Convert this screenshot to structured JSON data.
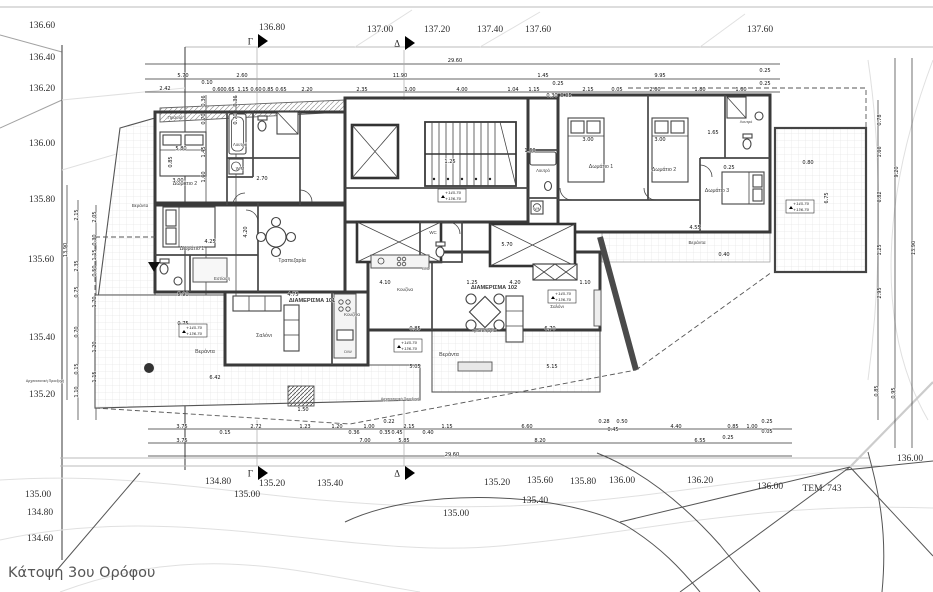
{
  "title": "Κάτοψη 3ου Ορόφου",
  "parcel_label": "ΤΕΜ. 743",
  "colors": {
    "wall": "#3a3a3a",
    "tile": "#dcdcdc",
    "hatch": "#9a9a9a",
    "contour_light": "#e0e0e0",
    "contour_dark": "#555555",
    "accent": "#000000"
  },
  "contours": {
    "left": [
      {
        "x": 42,
        "y": 28,
        "v": "136.60"
      },
      {
        "x": 42,
        "y": 60,
        "v": "136.40"
      },
      {
        "x": 42,
        "y": 91,
        "v": "136.20"
      },
      {
        "x": 42,
        "y": 146,
        "v": "136.00"
      },
      {
        "x": 42,
        "y": 202,
        "v": "135.80"
      },
      {
        "x": 41,
        "y": 262,
        "v": "135.60"
      },
      {
        "x": 42,
        "y": 340,
        "v": "135.40"
      },
      {
        "x": 42,
        "y": 397,
        "v": "135.20"
      },
      {
        "x": 38,
        "y": 497,
        "v": "135.00"
      },
      {
        "x": 40,
        "y": 515,
        "v": "134.80"
      },
      {
        "x": 40,
        "y": 541,
        "v": "134.60"
      }
    ],
    "top": [
      {
        "x": 272,
        "y": 30,
        "v": "136.80"
      },
      {
        "x": 380,
        "y": 32,
        "v": "137.00"
      },
      {
        "x": 437,
        "y": 32,
        "v": "137.20"
      },
      {
        "x": 490,
        "y": 32,
        "v": "137.40"
      },
      {
        "x": 538,
        "y": 32,
        "v": "137.60"
      },
      {
        "x": 760,
        "y": 32,
        "v": "137.60"
      }
    ],
    "bottom": [
      {
        "x": 218,
        "y": 484,
        "v": "134.80"
      },
      {
        "x": 272,
        "y": 486,
        "v": "135.20"
      },
      {
        "x": 247,
        "y": 497,
        "v": "135.00"
      },
      {
        "x": 330,
        "y": 486,
        "v": "135.40"
      },
      {
        "x": 497,
        "y": 485,
        "v": "135.20"
      },
      {
        "x": 540,
        "y": 483,
        "v": "135.60"
      },
      {
        "x": 535,
        "y": 503,
        "v": "135.40"
      },
      {
        "x": 456,
        "y": 516,
        "v": "135.00"
      },
      {
        "x": 583,
        "y": 484,
        "v": "135.80"
      },
      {
        "x": 622,
        "y": 483,
        "v": "136.00"
      },
      {
        "x": 700,
        "y": 483,
        "v": "136.20"
      },
      {
        "x": 770,
        "y": 489,
        "v": "136.00"
      },
      {
        "x": 910,
        "y": 461,
        "v": "136.00"
      }
    ]
  },
  "sections": [
    {
      "l": "Γ",
      "x": 257,
      "y": 41
    },
    {
      "l": "Δ",
      "x": 404,
      "y": 43
    },
    {
      "l": "Γ",
      "x": 257,
      "y": 473
    },
    {
      "l": "Δ",
      "x": 404,
      "y": 473
    }
  ],
  "levels": [
    {
      "x": 193,
      "y": 331,
      "l1": "+145.70",
      "l2": "+136.70"
    },
    {
      "x": 452,
      "y": 196,
      "l1": "+145.70",
      "l2": "+136.70"
    },
    {
      "x": 562,
      "y": 297,
      "l1": "+145.70",
      "l2": "+136.70"
    },
    {
      "x": 800,
      "y": 207,
      "l1": "+145.70",
      "l2": "+136.70"
    },
    {
      "x": 408,
      "y": 346,
      "l1": "+145.70",
      "l2": "+136.70"
    }
  ],
  "rooms": [
    {
      "x": 175,
      "y": 119,
      "v": "Πρασιά",
      "fs": 4.6
    },
    {
      "x": 185,
      "y": 185,
      "v": "Δωμάτιο 2"
    },
    {
      "x": 240,
      "y": 146,
      "v": "Λουτρό",
      "fs": 4.3
    },
    {
      "x": 240,
      "y": 170,
      "v": "W/M",
      "fs": 4.2
    },
    {
      "x": 140,
      "y": 207,
      "v": "Βεράντα",
      "fs": 4.4
    },
    {
      "x": 192,
      "y": 250,
      "v": "Δωμάτιο 1"
    },
    {
      "x": 222,
      "y": 280,
      "v": "Εστίαση",
      "fs": 4.4
    },
    {
      "x": 292,
      "y": 262,
      "v": "Τραπεζαρία"
    },
    {
      "x": 264,
      "y": 337,
      "v": "Σαλόνι"
    },
    {
      "x": 205,
      "y": 353,
      "v": "Βεράντα"
    },
    {
      "x": 312,
      "y": 302,
      "v": "ΔΙΑΜΕΡΙΣΜΑ 101",
      "fs": 5.6,
      "b": 1
    },
    {
      "x": 352,
      "y": 316,
      "v": "Κουζίνα",
      "fs": 4.6
    },
    {
      "x": 348,
      "y": 353,
      "v": "D/W",
      "fs": 3.9
    },
    {
      "x": 405,
      "y": 291,
      "v": "Κουζίνα",
      "fs": 4.6
    },
    {
      "x": 426,
      "y": 270,
      "v": "D/W",
      "fs": 3.9
    },
    {
      "x": 494,
      "y": 289,
      "v": "ΔΙΑΜΕΡΙΣΜΑ 102",
      "fs": 5.6,
      "b": 1
    },
    {
      "x": 484,
      "y": 332,
      "v": "Τραπεζαρία",
      "fs": 4.8
    },
    {
      "x": 557,
      "y": 308,
      "v": "Σαλόνι",
      "fs": 4.6
    },
    {
      "x": 449,
      "y": 356,
      "v": "Βεράντα"
    },
    {
      "x": 433,
      "y": 234,
      "v": "WC",
      "fs": 4.4
    },
    {
      "x": 543,
      "y": 172,
      "v": "Λουτρό",
      "fs": 4.2
    },
    {
      "x": 537,
      "y": 210,
      "v": "W/M",
      "fs": 4
    },
    {
      "x": 601,
      "y": 168,
      "v": "Δωμάτιο 1"
    },
    {
      "x": 664,
      "y": 171,
      "v": "Δωμάτιο 2"
    },
    {
      "x": 717,
      "y": 192,
      "v": "Δωμάτιο 3"
    },
    {
      "x": 746,
      "y": 123,
      "v": "Λουτρό",
      "fs": 3.8
    },
    {
      "x": 697,
      "y": 244,
      "v": "Βεράντα",
      "fs": 4.6
    },
    {
      "x": 45,
      "y": 382,
      "v": "Αρχιτεκτονική Προεξοχή",
      "fs": 3.6
    },
    {
      "x": 400,
      "y": 400,
      "v": "Αρχιτεκτονική Προεξοχή",
      "fs": 3.6
    }
  ],
  "dims": [
    {
      "x": 455,
      "y": 62,
      "v": "29.60"
    },
    {
      "x": 183,
      "y": 77,
      "v": "5.70"
    },
    {
      "x": 242,
      "y": 77,
      "v": "2.60"
    },
    {
      "x": 400,
      "y": 77,
      "v": "11.90"
    },
    {
      "x": 543,
      "y": 77,
      "v": "1.45"
    },
    {
      "x": 660,
      "y": 77,
      "v": "9.95"
    },
    {
      "x": 765,
      "y": 72,
      "v": "0.25"
    },
    {
      "x": 165,
      "y": 90,
      "v": "2.42"
    },
    {
      "x": 207,
      "y": 84,
      "v": "0.10"
    },
    {
      "x": 218,
      "y": 91,
      "v": "0.60"
    },
    {
      "x": 229,
      "y": 91,
      "v": "0.65"
    },
    {
      "x": 243,
      "y": 91,
      "v": "1.15"
    },
    {
      "x": 256,
      "y": 91,
      "v": "0.60"
    },
    {
      "x": 268,
      "y": 91,
      "v": "0.85"
    },
    {
      "x": 281,
      "y": 91,
      "v": "0.65"
    },
    {
      "x": 307,
      "y": 91,
      "v": "2.20"
    },
    {
      "x": 362,
      "y": 91,
      "v": "2.35"
    },
    {
      "x": 410,
      "y": 91,
      "v": "1.00"
    },
    {
      "x": 462,
      "y": 91,
      "v": "4.00"
    },
    {
      "x": 513,
      "y": 91,
      "v": "1.04"
    },
    {
      "x": 534,
      "y": 91,
      "v": "1.15"
    },
    {
      "x": 558,
      "y": 85,
      "v": "0.25"
    },
    {
      "x": 552,
      "y": 97,
      "v": "0.30"
    },
    {
      "x": 566,
      "y": 97,
      "v": "0.05"
    },
    {
      "x": 588,
      "y": 91,
      "v": "2.15"
    },
    {
      "x": 617,
      "y": 91,
      "v": "0.05"
    },
    {
      "x": 655,
      "y": 91,
      "v": "2.60"
    },
    {
      "x": 700,
      "y": 91,
      "v": "1.80"
    },
    {
      "x": 741,
      "y": 91,
      "v": "1.60"
    },
    {
      "x": 765,
      "y": 85,
      "v": "0.25"
    },
    {
      "x": 182,
      "y": 428,
      "v": "3.75"
    },
    {
      "x": 225,
      "y": 434,
      "v": "0.15"
    },
    {
      "x": 256,
      "y": 428,
      "v": "2.72"
    },
    {
      "x": 305,
      "y": 428,
      "v": "1.23"
    },
    {
      "x": 337,
      "y": 428,
      "v": "1.20"
    },
    {
      "x": 354,
      "y": 434,
      "v": "0.36"
    },
    {
      "x": 369,
      "y": 428,
      "v": "1.00"
    },
    {
      "x": 389,
      "y": 423,
      "v": "0.22"
    },
    {
      "x": 385,
      "y": 434,
      "v": "0.35"
    },
    {
      "x": 397,
      "y": 434,
      "v": "0.45"
    },
    {
      "x": 409,
      "y": 428,
      "v": "2.15"
    },
    {
      "x": 428,
      "y": 434,
      "v": "0.40"
    },
    {
      "x": 447,
      "y": 428,
      "v": "1.15"
    },
    {
      "x": 527,
      "y": 428,
      "v": "6.60"
    },
    {
      "x": 604,
      "y": 423,
      "v": "0.28"
    },
    {
      "x": 622,
      "y": 423,
      "v": "0.50"
    },
    {
      "x": 613,
      "y": 431,
      "v": "0.45"
    },
    {
      "x": 676,
      "y": 428,
      "v": "4.40"
    },
    {
      "x": 733,
      "y": 428,
      "v": "0.85"
    },
    {
      "x": 752,
      "y": 428,
      "v": "1.00"
    },
    {
      "x": 767,
      "y": 423,
      "v": "0.25"
    },
    {
      "x": 767,
      "y": 433,
      "v": "0.05"
    },
    {
      "x": 182,
      "y": 442,
      "v": "3.75"
    },
    {
      "x": 365,
      "y": 442,
      "v": "7.00"
    },
    {
      "x": 728,
      "y": 439,
      "v": "0.25"
    },
    {
      "x": 404,
      "y": 442,
      "v": "5.85"
    },
    {
      "x": 540,
      "y": 442,
      "v": "8.20"
    },
    {
      "x": 700,
      "y": 442,
      "v": "6.55"
    },
    {
      "x": 452,
      "y": 456,
      "v": "29.60"
    },
    {
      "x": 303,
      "y": 411,
      "v": "1.50"
    },
    {
      "x": 205,
      "y": 101,
      "v": "0.36",
      "r": 1
    },
    {
      "x": 205,
      "y": 119,
      "v": "0.70",
      "r": 1
    },
    {
      "x": 237,
      "y": 101,
      "v": "0.36",
      "r": 1
    },
    {
      "x": 237,
      "y": 119,
      "v": "0.70",
      "r": 1
    },
    {
      "x": 205,
      "y": 152,
      "v": "1.45",
      "r": 1
    },
    {
      "x": 205,
      "y": 177,
      "v": "1.60",
      "r": 1
    },
    {
      "x": 172,
      "y": 162,
      "v": "0.85",
      "r": 1
    },
    {
      "x": 67,
      "y": 250,
      "v": "13.90",
      "r": 1
    },
    {
      "x": 78,
      "y": 215,
      "v": "2.15",
      "r": 1
    },
    {
      "x": 96,
      "y": 217,
      "v": "2.05",
      "r": 1
    },
    {
      "x": 96,
      "y": 240,
      "v": "0.30",
      "r": 1
    },
    {
      "x": 96,
      "y": 255,
      "v": "1.15",
      "r": 1
    },
    {
      "x": 78,
      "y": 266,
      "v": "2.35",
      "r": 1
    },
    {
      "x": 96,
      "y": 271,
      "v": "0.50",
      "r": 1
    },
    {
      "x": 78,
      "y": 292,
      "v": "0.75",
      "r": 1
    },
    {
      "x": 96,
      "y": 302,
      "v": "1.70",
      "r": 1
    },
    {
      "x": 78,
      "y": 332,
      "v": "0.70",
      "r": 1
    },
    {
      "x": 96,
      "y": 347,
      "v": "1.20",
      "r": 1
    },
    {
      "x": 78,
      "y": 369,
      "v": "0.15",
      "r": 1
    },
    {
      "x": 96,
      "y": 377,
      "v": "1.15",
      "r": 1
    },
    {
      "x": 78,
      "y": 392,
      "v": "1.10",
      "r": 1
    },
    {
      "x": 881,
      "y": 120,
      "v": "0.78",
      "r": 1
    },
    {
      "x": 881,
      "y": 152,
      "v": "1.66",
      "r": 1
    },
    {
      "x": 898,
      "y": 172,
      "v": "9.20",
      "r": 1
    },
    {
      "x": 881,
      "y": 197,
      "v": "6.82",
      "r": 1
    },
    {
      "x": 881,
      "y": 250,
      "v": "1.25",
      "r": 1
    },
    {
      "x": 915,
      "y": 248,
      "v": "13.90",
      "r": 1
    },
    {
      "x": 881,
      "y": 293,
      "v": "2.95",
      "r": 1
    },
    {
      "x": 878,
      "y": 391,
      "v": "0.85",
      "r": 1
    },
    {
      "x": 895,
      "y": 393,
      "v": "0.95",
      "r": 1
    },
    {
      "x": 181,
      "y": 150,
      "v": "5.80"
    },
    {
      "x": 178,
      "y": 182,
      "v": "3.00"
    },
    {
      "x": 262,
      "y": 180,
      "v": "2.70"
    },
    {
      "x": 210,
      "y": 243,
      "v": "4.25"
    },
    {
      "x": 183,
      "y": 296,
      "v": "5.90"
    },
    {
      "x": 183,
      "y": 325,
      "v": "0.75"
    },
    {
      "x": 215,
      "y": 379,
      "v": "6.42"
    },
    {
      "x": 293,
      "y": 296,
      "v": "4.75"
    },
    {
      "x": 385,
      "y": 284,
      "v": "4.10"
    },
    {
      "x": 472,
      "y": 284,
      "v": "1.25"
    },
    {
      "x": 515,
      "y": 284,
      "v": "4.20"
    },
    {
      "x": 585,
      "y": 284,
      "v": "1.10"
    },
    {
      "x": 415,
      "y": 330,
      "v": "0.85"
    },
    {
      "x": 550,
      "y": 330,
      "v": "6.70"
    },
    {
      "x": 415,
      "y": 368,
      "v": "5.05"
    },
    {
      "x": 552,
      "y": 368,
      "v": "5.15"
    },
    {
      "x": 588,
      "y": 141,
      "v": "3.00"
    },
    {
      "x": 660,
      "y": 141,
      "v": "3.00"
    },
    {
      "x": 713,
      "y": 134,
      "v": "1.65"
    },
    {
      "x": 729,
      "y": 169,
      "v": "0.25"
    },
    {
      "x": 695,
      "y": 229,
      "v": "4.55"
    },
    {
      "x": 450,
      "y": 163,
      "v": "1.25"
    },
    {
      "x": 530,
      "y": 152,
      "v": "1.60"
    },
    {
      "x": 507,
      "y": 246,
      "v": "5.70"
    },
    {
      "x": 828,
      "y": 198,
      "v": "6.75",
      "r": 1
    },
    {
      "x": 808,
      "y": 164,
      "v": "0.80"
    },
    {
      "x": 724,
      "y": 256,
      "v": "0.40"
    },
    {
      "x": 247,
      "y": 232,
      "v": "4.20",
      "r": 1
    }
  ]
}
